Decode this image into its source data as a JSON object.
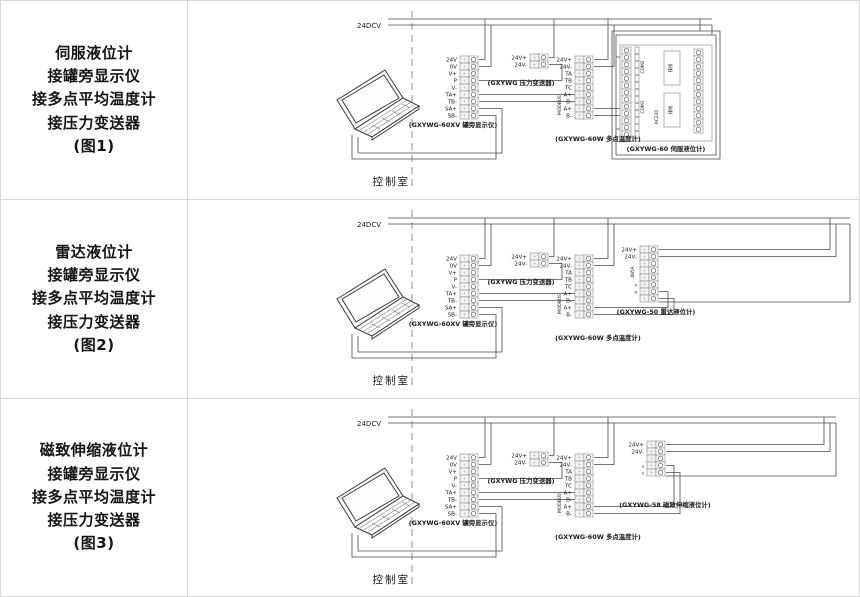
{
  "rows": [
    {
      "caption": [
        "伺服液位计",
        "接罐旁显示仪",
        "接多点平均温度计",
        "接压力变送器",
        "(图1)"
      ],
      "bus_label": "24DCV",
      "room_label": "控制室",
      "display": {
        "label": "(GXYWG-60XV 罐旁显示仪)",
        "terminals": [
          "24V",
          "0V",
          "V+",
          "P",
          "V-",
          "TA+",
          "TB-",
          "SA+",
          "SB-"
        ]
      },
      "pressure": {
        "label": "(GXYWG 压力变送器)",
        "terminals": [
          "24V+",
          "24V-"
        ]
      },
      "temperature": {
        "label": "(GXYWG-60W 多点温度计)",
        "side_label": "MODBUS",
        "terminals": [
          "24V+",
          "24V-",
          "TA",
          "TB",
          "TC",
          "A+",
          "B-",
          "A+",
          "B-"
        ]
      },
      "gauge": {
        "label": "(GXYWG-60 伺服液位计)",
        "com_upper": "COM2",
        "com_lower": "COM1",
        "power_label": "AC220",
        "ribbon_label_1": "排线",
        "ribbon_label_2": "排线"
      }
    },
    {
      "caption": [
        "雷达液位计",
        "接罐旁显示仪",
        "接多点平均温度计",
        "接压力变送器",
        "(图2)"
      ],
      "bus_label": "24DCV",
      "room_label": "控制室",
      "display": {
        "label": "(GXYWG-60XV 罐旁显示仪)",
        "terminals": [
          "24V",
          "0V",
          "V+",
          "P",
          "V-",
          "TA+",
          "TB-",
          "SA+",
          "SB-"
        ]
      },
      "pressure": {
        "label": "(GXYWG 压力变送器)",
        "terminals": [
          "24V+",
          "24V-"
        ]
      },
      "temperature": {
        "label": "(GXYWG-60W 多点温度计)",
        "side_label": "MODBUS",
        "terminals": [
          "24V+",
          "24V-",
          "TA",
          "TB",
          "TC",
          "A+",
          "B-",
          "A+",
          "B-"
        ]
      },
      "gauge": {
        "label": "(GXYWG-50 雷达液位计)",
        "terminals": [
          "24V+",
          "24V-"
        ],
        "side_label": "485A",
        "extra_labels": [
          "A",
          "B"
        ]
      }
    },
    {
      "caption": [
        "磁致伸缩液位计",
        "接罐旁显示仪",
        "接多点平均温度计",
        "接压力变送器",
        "(图3)"
      ],
      "bus_label": "24DCV",
      "room_label": "控制室",
      "display": {
        "label": "(GXYWG-60XV 罐旁显示仪)",
        "terminals": [
          "24V",
          "0V",
          "V+",
          "P",
          "V-",
          "TA+",
          "TB-",
          "SA+",
          "SB-"
        ]
      },
      "pressure": {
        "label": "(GXYWG 压力变送器)",
        "terminals": [
          "24V+",
          "24V-"
        ]
      },
      "temperature": {
        "label": "(GXYWG-60W 多点温度计)",
        "side_label": "MODBUS",
        "terminals": [
          "24V+",
          "24V-",
          "TA",
          "TB",
          "TC",
          "A+",
          "B-",
          "A+",
          "B-"
        ]
      },
      "gauge": {
        "label": "(GXYWG-58 磁致伸缩液位计)",
        "terminals": [
          "24V+",
          "24V-"
        ],
        "extra_labels": [
          "a",
          "b"
        ]
      }
    }
  ]
}
